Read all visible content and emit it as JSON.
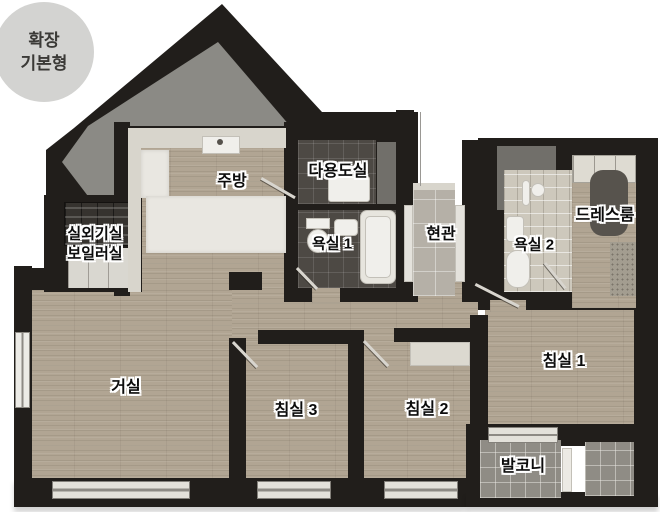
{
  "badge": {
    "line1": "확장",
    "line2": "기본형"
  },
  "rooms": {
    "kitchen": "주방",
    "utility": "다용도실",
    "outdoor_unit": "실외기실",
    "boiler": "보일러실",
    "bath1": "욕실 1",
    "entrance": "현관",
    "bath2": "욕실 2",
    "dressroom": "드레스룸",
    "living": "거실",
    "bedroom3": "침실 3",
    "bedroom2": "침실 2",
    "bedroom1": "침실 1",
    "balcony": "발코니"
  },
  "colors": {
    "wall": "#211e1b",
    "roof_interior": "#8b8a85",
    "wood_floor": "#b1a593",
    "dark_tile": "#4d4944",
    "light_tile": "#cdc8bc",
    "entrance_tile": "#b5b0a7",
    "balcony_tile": "#8f8c85",
    "badge_bg": "#d3d3d1",
    "label_text": "#0c0c0c",
    "label_outline": "#ffffff"
  }
}
